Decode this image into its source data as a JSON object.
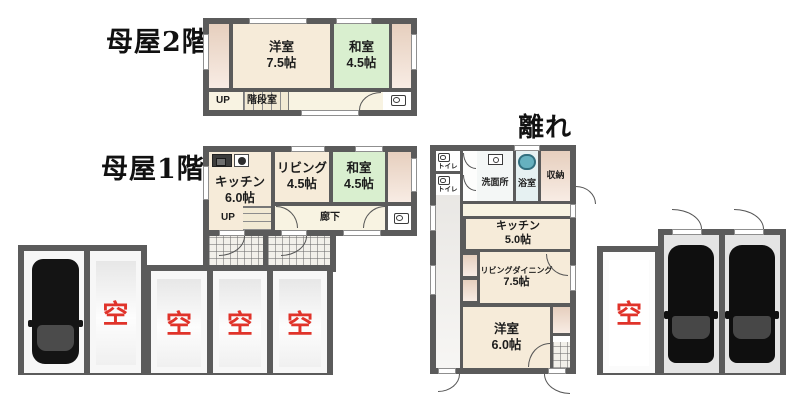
{
  "colors": {
    "wall": "#5b5b5b",
    "red": "#e0332a",
    "cream": "#f6ebd9",
    "cream-light": "#f8f3e2",
    "green": "#d9efcf",
    "bathbg": "#e6f1f2"
  },
  "floor2f": {
    "title": "母屋2階",
    "yoshitsu_name": "洋室",
    "yoshitsu_size": "7.5帖",
    "washitsu_name": "和室",
    "washitsu_size": "4.5帖",
    "up": "UP",
    "stair_room": "階段室"
  },
  "floor1f": {
    "title": "母屋1階",
    "kitchen_name": "キッチン",
    "kitchen_size": "6.0帖",
    "living_name": "リビング",
    "living_size": "4.5帖",
    "washitsu_name": "和室",
    "washitsu_size": "4.5帖",
    "up": "UP",
    "hall": "廊下"
  },
  "hanare": {
    "title": "離れ",
    "toilet": "トイレ",
    "washroom": "洗面所",
    "bath": "浴室",
    "storage": "収納",
    "kitchen_name": "キッチン",
    "kitchen_size": "5.0帖",
    "ld_name": "リビングダイニング",
    "ld_size": "7.5帖",
    "yoshitsu_name": "洋室",
    "yoshitsu_size": "6.0帖"
  },
  "parking": {
    "vacant": "空",
    "left_stalls": [
      {
        "status": "car"
      },
      {
        "status": "vacant"
      },
      {
        "status": "vacant"
      },
      {
        "status": "vacant"
      },
      {
        "status": "vacant"
      }
    ],
    "right_stalls": [
      {
        "status": "vacant"
      },
      {
        "status": "car"
      },
      {
        "status": "car"
      }
    ]
  }
}
